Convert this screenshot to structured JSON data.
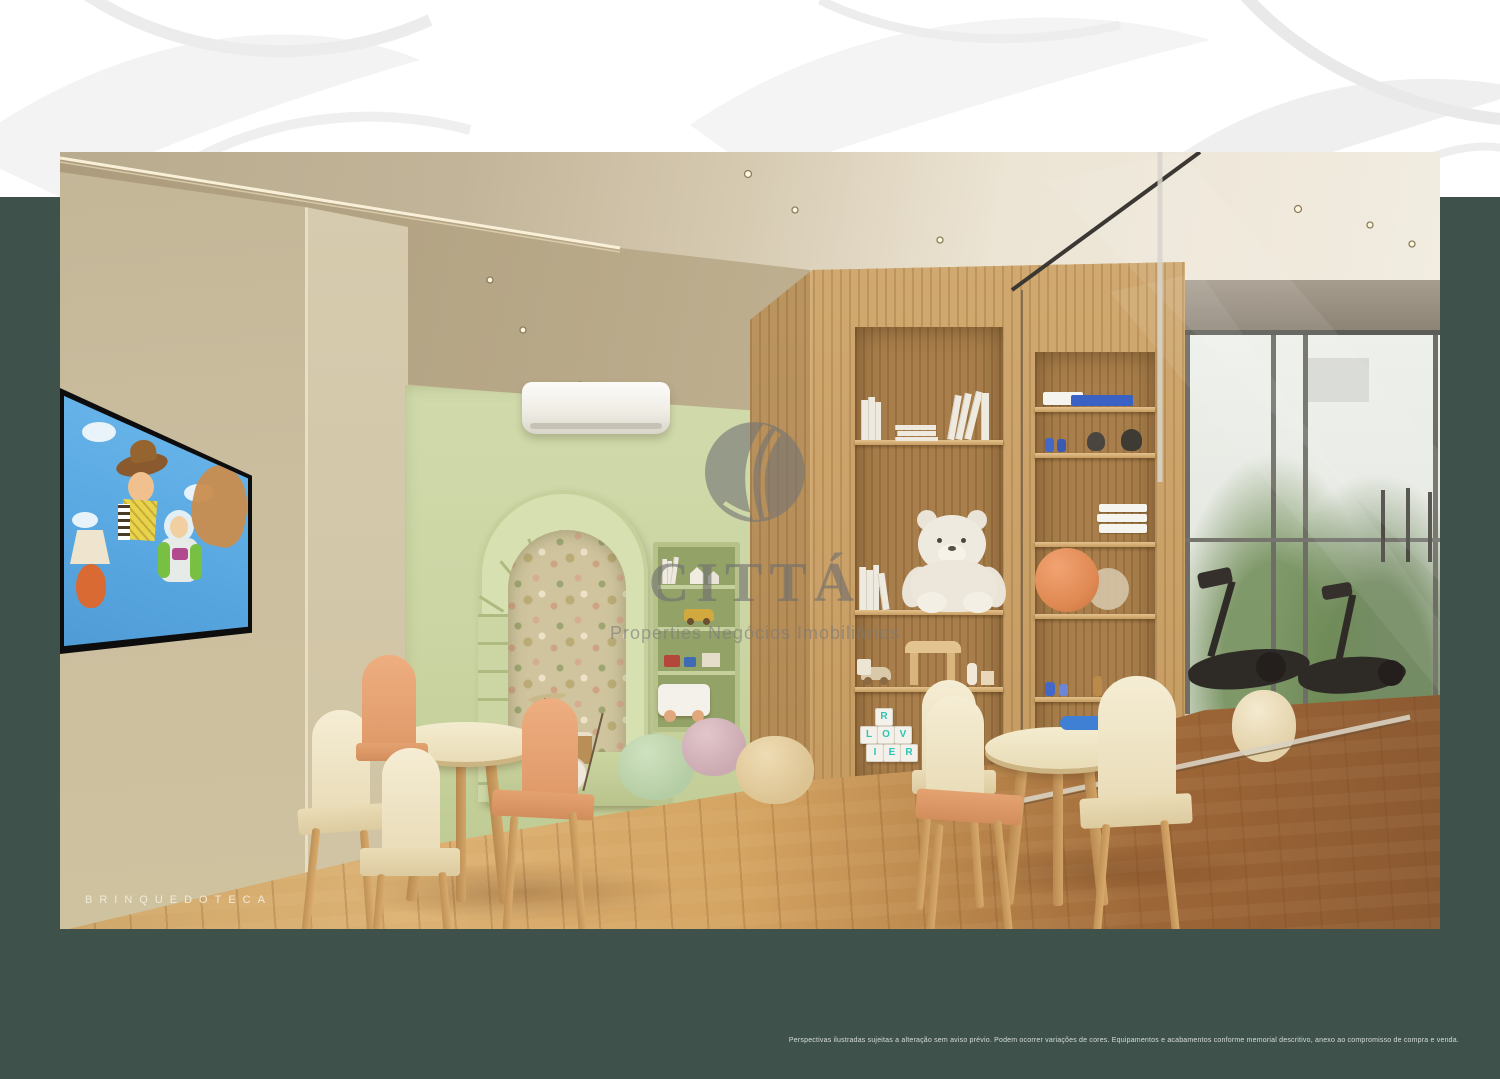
{
  "page": {
    "caption": "BRINQUEDOTECA",
    "disclaimer": "Perspectivas ilustradas sujeitas a alteração sem aviso prévio. Podem ocorrer variações de cores. Equipamentos e acabamentos conforme memorial descritivo, anexo ao compromisso de compra e venda.",
    "colors": {
      "frame_green": "#3E524B",
      "band_white": "#FFFFFF"
    }
  },
  "watermark": {
    "title": "CITTÁ",
    "subtitle": "Properties Negócios Imobiliários",
    "color": "#7A7A7A"
  },
  "scene": {
    "description": "Render of a children's playroom with kids tables, arched niche and toy shelves, next to a gym behind a glass partition",
    "tv_content": "Toy Story cartoon on wall TV",
    "blocks": [
      "R",
      "L",
      "O",
      "V",
      "I",
      "E",
      "R"
    ],
    "colors": {
      "wall_beige": "#C8BC9E",
      "wall_green": "#CBD5A4",
      "wood": "#C79E66",
      "floor": "#C9975C",
      "gym_floor": "#8A5830",
      "pouf_mint": "#C3D8B3",
      "pouf_pink": "#D9BCC2",
      "pouf_cream": "#E8D2A6",
      "chair_peach": "#E8A87A",
      "chair_cream": "#F2E9CE",
      "ball_orange": "#E58F5F",
      "teddy_white": "#EDE9DF",
      "block_letter_teal": "#2EC4B6"
    }
  }
}
